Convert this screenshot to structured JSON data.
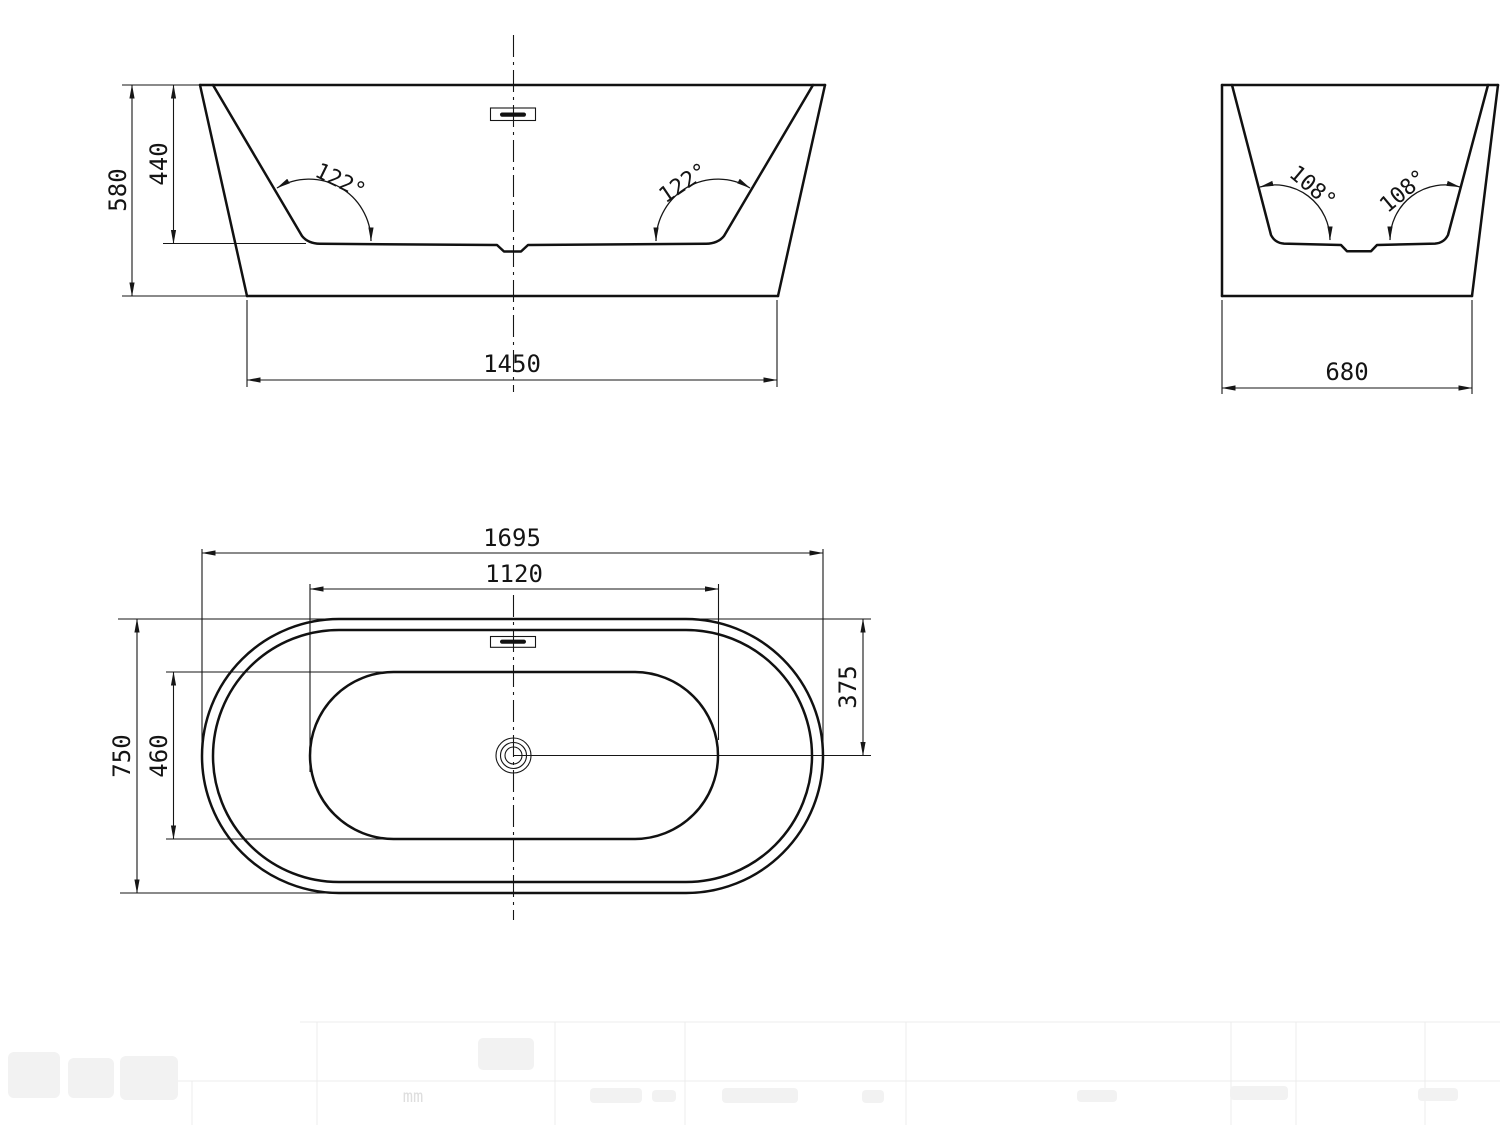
{
  "drawing": {
    "units_label": "mm",
    "views": {
      "front": {
        "overall_height": "580",
        "inner_depth": "440",
        "base_width": "1450",
        "left_wall_angle": "122°",
        "right_wall_angle": "122°"
      },
      "side": {
        "base_width": "680",
        "left_wall_angle": "108°",
        "right_wall_angle": "108°"
      },
      "plan": {
        "overall_length": "1695",
        "inner_length": "1120",
        "overall_width": "750",
        "inner_width": "460",
        "drain_center_offset": "375"
      }
    }
  }
}
